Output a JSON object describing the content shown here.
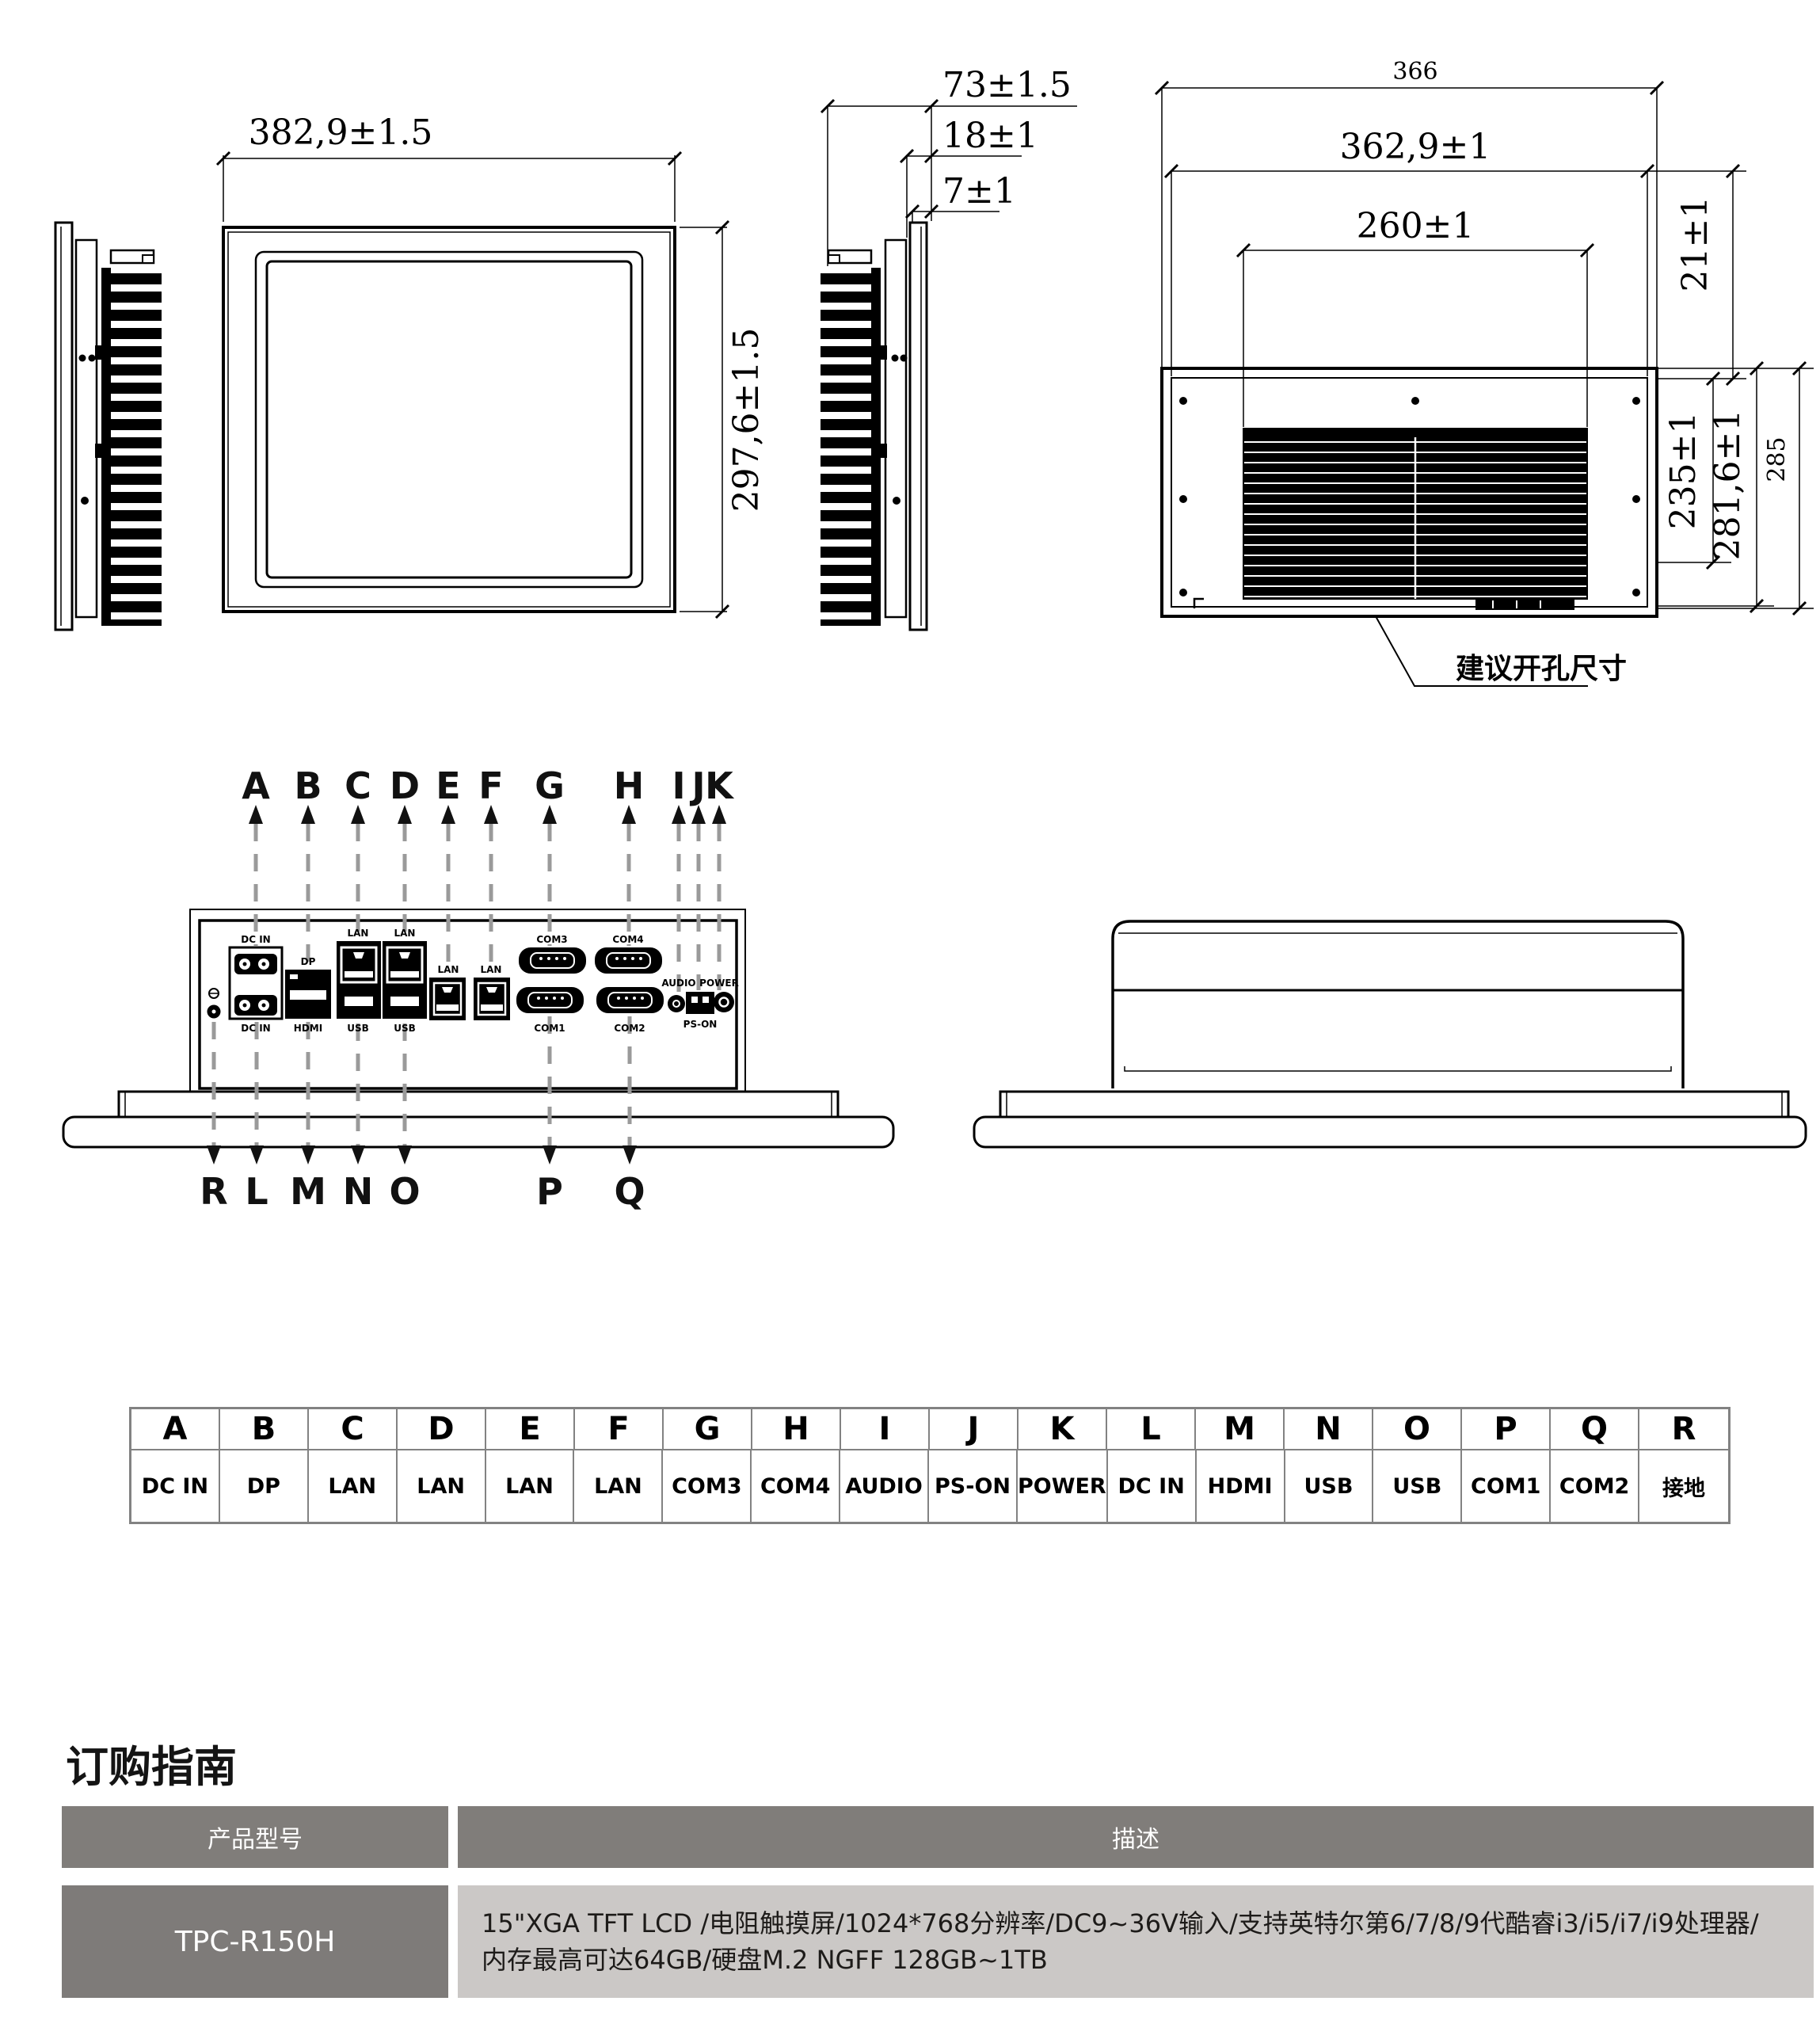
{
  "dimensions": {
    "front_width": "382,9±1.5",
    "front_height": "297,6±1.5",
    "side_total": "73±1.5",
    "side_mid": "18±1",
    "side_front": "7±1",
    "rear_total_width": "366",
    "rear_width": "362,9±1",
    "heatsink_width": "260±1",
    "rear_offset": "21±1",
    "heatsink_height": "235±1",
    "rear_height": "281,6±1",
    "rear_total_height": "285",
    "cutout_note": "建议开孔尺寸"
  },
  "annotations": {
    "top": [
      "A",
      "B",
      "C",
      "D",
      "E",
      "F",
      "G",
      "H",
      "I",
      "J",
      "K"
    ],
    "bottom": [
      "R",
      "L",
      "M",
      "N",
      "O",
      "P",
      "Q"
    ]
  },
  "panel_labels": [
    "DC IN",
    "DP",
    "LAN",
    "LAN",
    "LAN",
    "LAN",
    "COM3",
    "COM4",
    "AUDIO",
    "POWER",
    "DC IN",
    "HDMI",
    "USB",
    "USB",
    "COM1",
    "COM2",
    "PS-ON"
  ],
  "port_map": {
    "letters": [
      "A",
      "B",
      "C",
      "D",
      "E",
      "F",
      "G",
      "H",
      "I",
      "J",
      "K",
      "L",
      "M",
      "N",
      "O",
      "P",
      "Q",
      "R"
    ],
    "labels": [
      "DC IN",
      "DP",
      "LAN",
      "LAN",
      "LAN",
      "LAN",
      "COM3",
      "COM4",
      "AUDIO",
      "PS-ON",
      "POWER",
      "DC IN",
      "HDMI",
      "USB",
      "USB",
      "COM1",
      "COM2",
      "接地"
    ]
  },
  "ordering": {
    "title": "订购指南",
    "col_model": "产品型号",
    "col_desc": "描述",
    "model": "TPC-R150H",
    "desc_line1": "15\"XGA TFT LCD /电阻触摸屏/1024*768分辨率/DC9~36V输入/支持英特尔第6/7/8/9代酷睿i3/i5/i7/i9处理器/",
    "desc_line2": "内存最高可达64GB/硬盘M.2 NGFF 128GB~1TB"
  }
}
